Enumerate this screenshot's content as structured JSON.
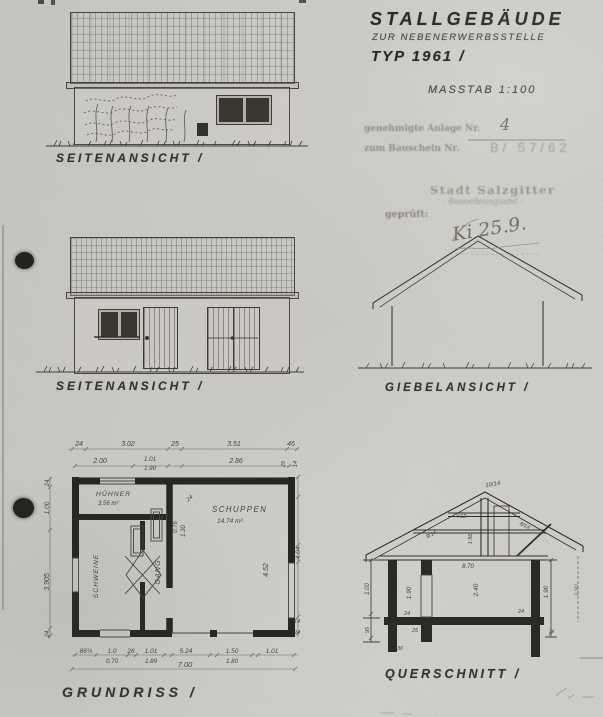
{
  "page": {
    "paper_color": "#cac8c4",
    "ink_color": "#2e2d29",
    "faded_stamp_color": "#8f8f88"
  },
  "title_block": {
    "title": "STALLGEBÄUDE",
    "subtitle": "ZUR NEBENERWERBSSTELLE",
    "type_line": "TYP 1961 /",
    "scale_label": "MASSTAB 1:100"
  },
  "stamp": {
    "approved_label": "genehmigte Anlage Nr.",
    "approved_value": "4",
    "permit_label": "zum Bauschein Nr.",
    "permit_value": "B/ 57/62",
    "authority": "Stadt Salzgitter",
    "department": "- Bauordnungsamt -",
    "checked_label": "geprüft:",
    "signature": "Ki 25.9."
  },
  "views": {
    "side_elevation_top": {
      "label": "SEITENANSICHT /"
    },
    "side_elevation_middle": {
      "label": "SEITENANSICHT /"
    },
    "gable_elevation": {
      "label": "GIEBELANSICHT /"
    }
  },
  "floor_plan": {
    "label": "GRUNDRISS /",
    "rooms": {
      "huehner_name": "HÜHNER",
      "huehner_area": "3.56 m²",
      "schweine_name": "SCHWEINE",
      "gang_name": "GANG",
      "schuppen_name": "SCHUPPEN",
      "schuppen_area": "14.74 m²"
    },
    "dims": {
      "top_row1": [
        "24",
        "3.02",
        "25",
        "3.51",
        "46"
      ],
      "top_row2": [
        "2.00",
        "1.01",
        "1.90",
        "2.86"
      ],
      "left_col": [
        "24",
        "1.00",
        "3.905",
        "24"
      ],
      "right_col": [
        "25",
        "14",
        "4.04",
        "14",
        "24"
      ],
      "bottom_row1": [
        "86½",
        "1.0",
        "26",
        "1.01",
        "5.24",
        "1.50",
        "1.01"
      ],
      "bottom_row2": [
        "0.70",
        "1.89",
        "1.80"
      ],
      "total_width": "7.00",
      "inner": [
        "0.76",
        "1.30",
        "4.52",
        ".24"
      ]
    }
  },
  "section": {
    "label": "QUERSCHNITT /",
    "dims": {
      "heights": [
        "1.90",
        "2.40",
        "1.90",
        "1.90"
      ],
      "left_col": [
        "1.00",
        "95"
      ],
      "truss": [
        "10/14",
        "8/14",
        "4/12",
        "8/14",
        "1.56",
        "8.70"
      ],
      "small": [
        "24",
        "24",
        "25",
        "30",
        "26"
      ]
    }
  }
}
